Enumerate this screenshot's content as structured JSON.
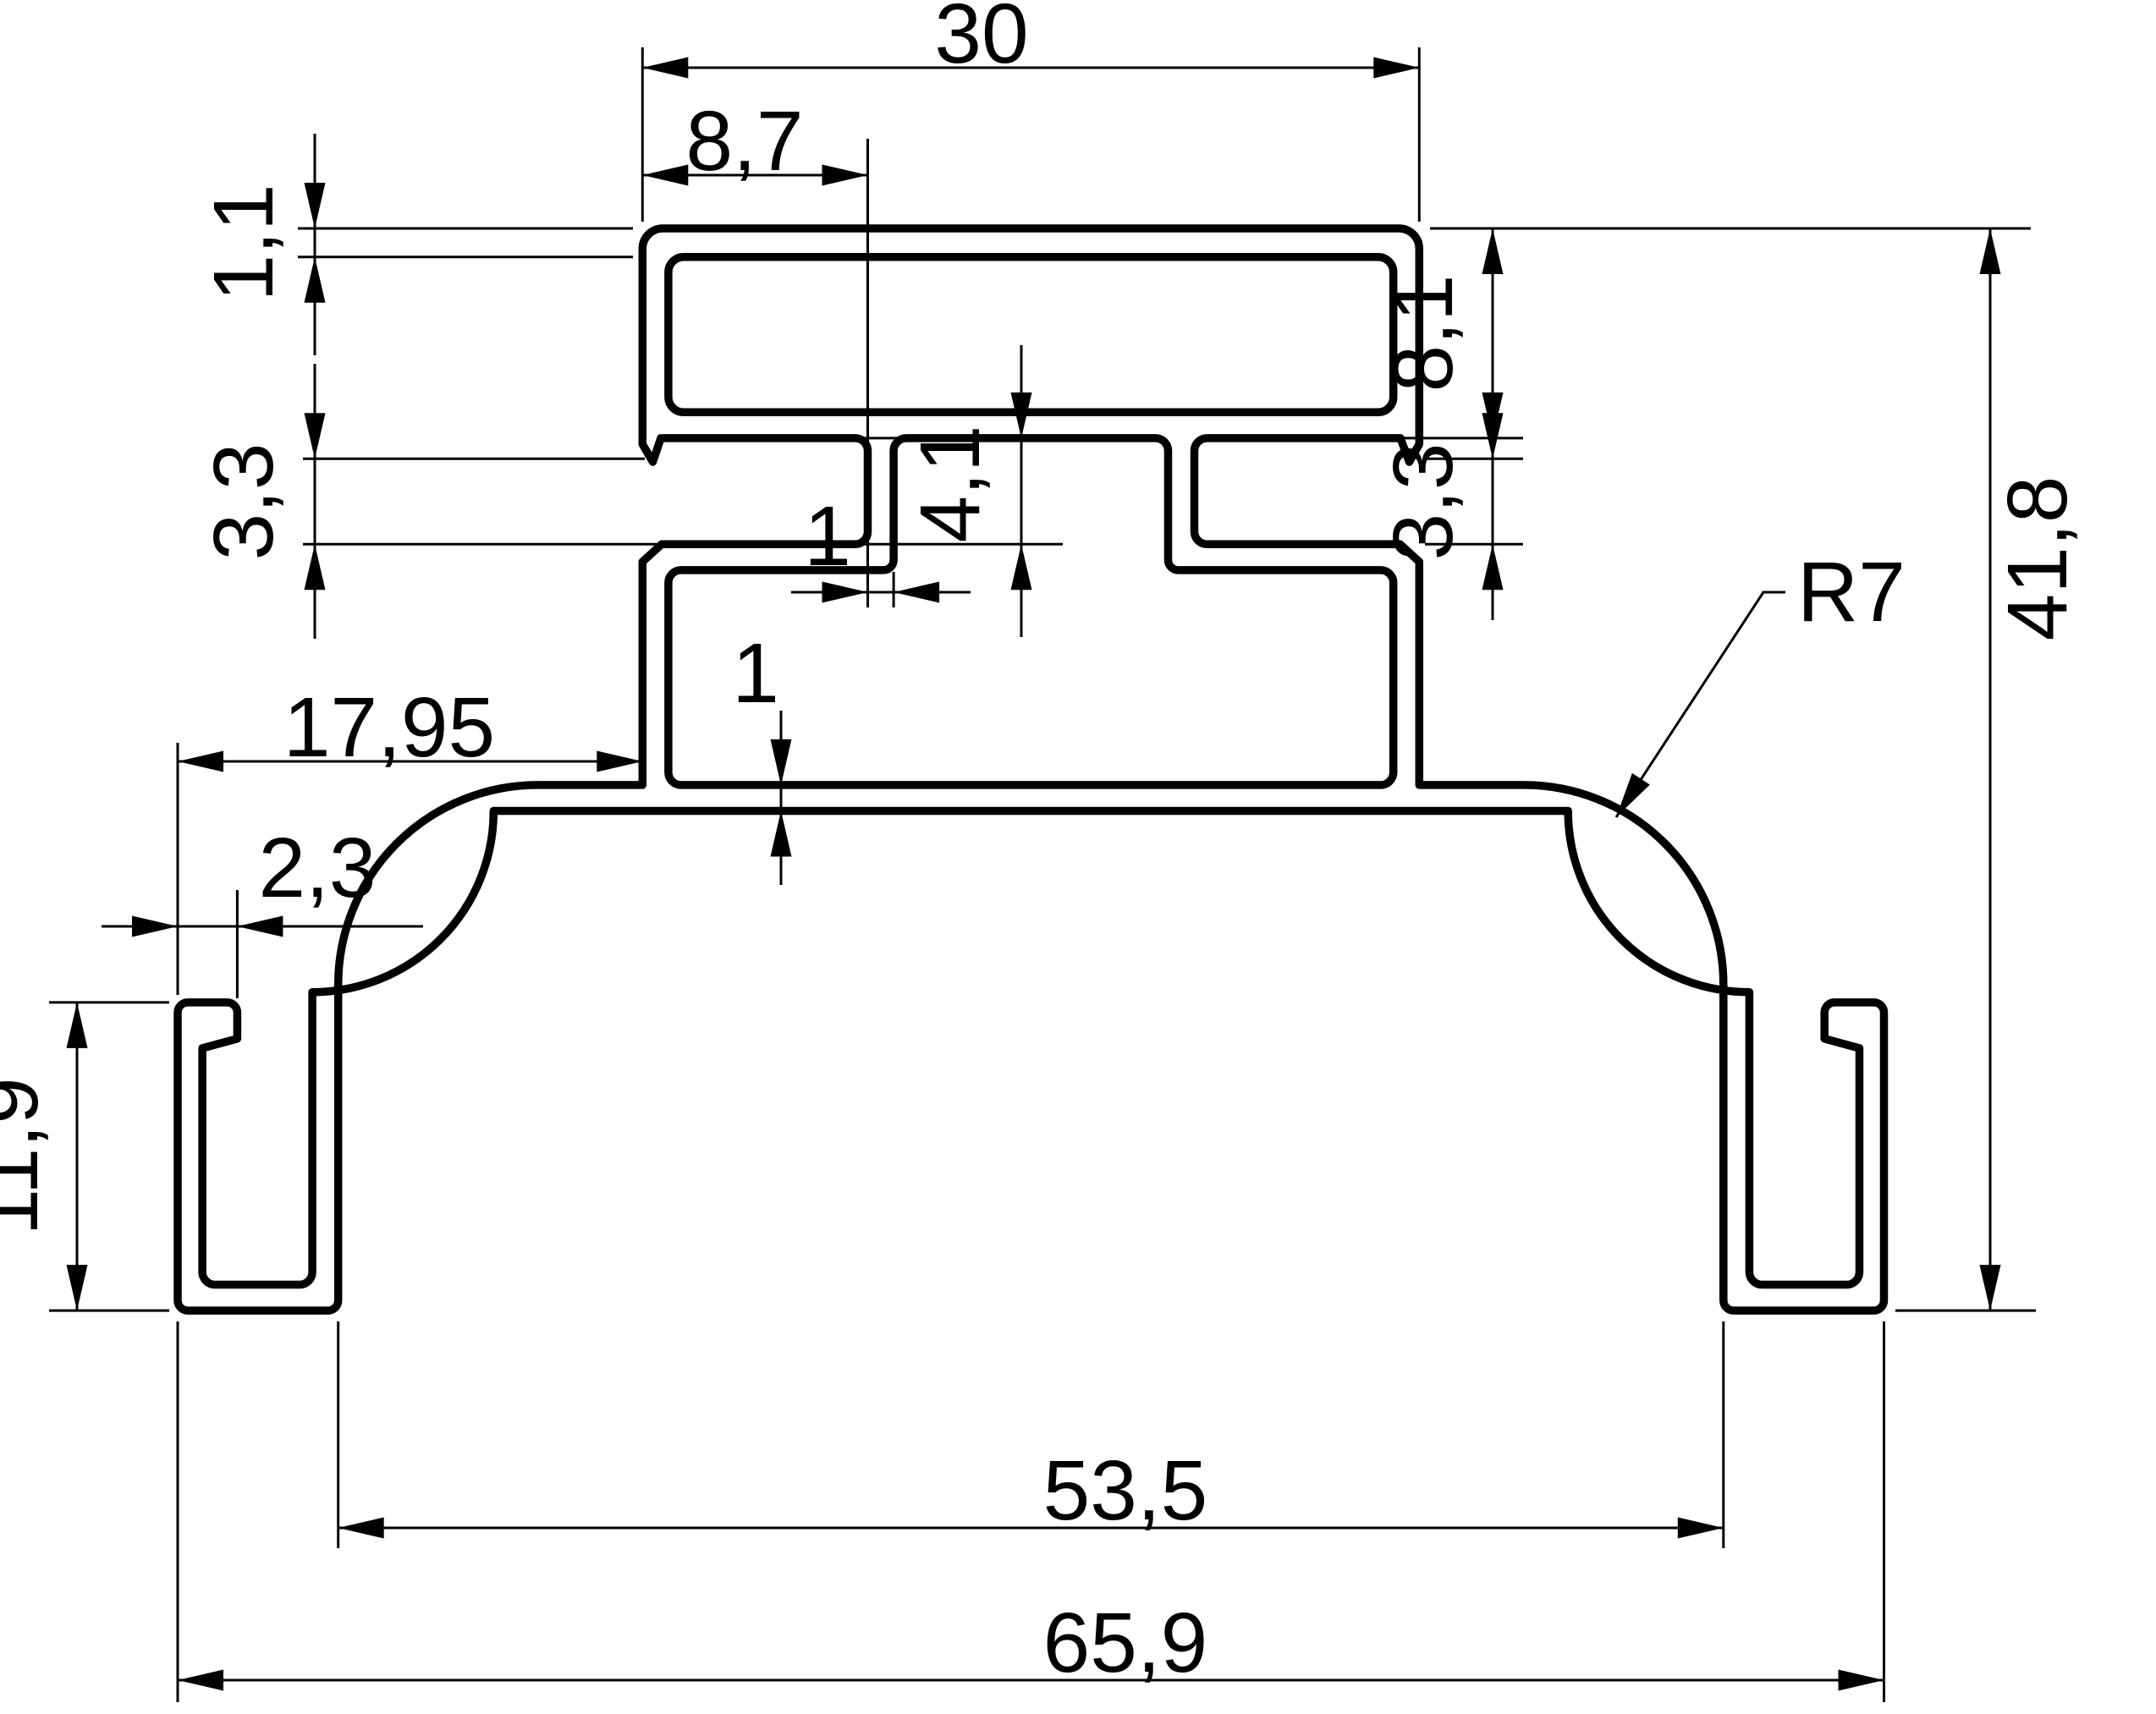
{
  "drawing": {
    "title": "aluminium-profile-cross-section",
    "background": "#ffffff",
    "line_color": "#000000",
    "dimensions": {
      "top_width": "30",
      "slot_depth": "8,7",
      "top_wall_thickness": "1,1",
      "left_slot_mouth": "3,3",
      "slot_cavity_height": "4,1",
      "slot_end_wall": "1",
      "right_box_height": "8,1",
      "right_slot_mouth": "3,3",
      "web_offset": "17,95",
      "foot_lip_width": "2,3",
      "base_thickness": "1",
      "corner_radius": "R7",
      "overall_height": "41,8",
      "foot_height": "11,9",
      "feet_inner_span": "53,5",
      "overall_width": "65,9"
    }
  }
}
